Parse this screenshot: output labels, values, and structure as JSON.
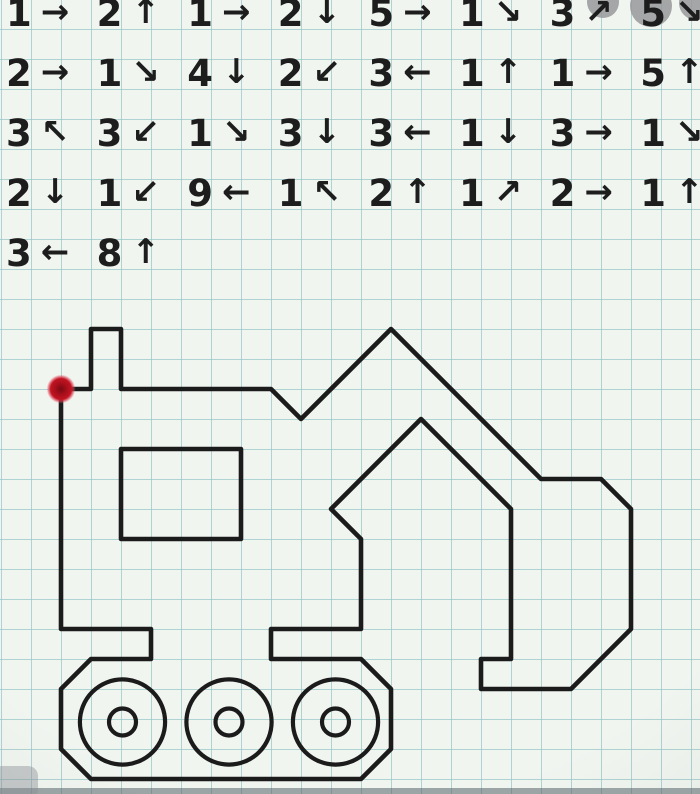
{
  "meta": {
    "title": "Graphical dictation worksheet - draw-by-arrows excavator"
  },
  "instructions": {
    "rows": [
      {
        "items": [
          {
            "n": "1",
            "dir": "right",
            "arrow": "→"
          },
          {
            "n": "2",
            "dir": "up",
            "arrow": "↑"
          },
          {
            "n": "1",
            "dir": "right",
            "arrow": "→"
          },
          {
            "n": "2",
            "dir": "down",
            "arrow": "↓"
          },
          {
            "n": "5",
            "dir": "right",
            "arrow": "→"
          },
          {
            "n": "1",
            "dir": "down-right",
            "arrow": "↘"
          },
          {
            "n": "3",
            "dir": "up-right",
            "arrow": "↗"
          },
          {
            "n": "5",
            "dir": "down-right",
            "arrow": "↘"
          }
        ]
      },
      {
        "items": [
          {
            "n": "2",
            "dir": "right",
            "arrow": "→"
          },
          {
            "n": "1",
            "dir": "down-right",
            "arrow": "↘"
          },
          {
            "n": "4",
            "dir": "down",
            "arrow": "↓"
          },
          {
            "n": "2",
            "dir": "down-left",
            "arrow": "↙"
          },
          {
            "n": "3",
            "dir": "left",
            "arrow": "←"
          },
          {
            "n": "1",
            "dir": "up",
            "arrow": "↑"
          },
          {
            "n": "1",
            "dir": "right",
            "arrow": "→"
          },
          {
            "n": "5",
            "dir": "up",
            "arrow": "↑"
          }
        ]
      },
      {
        "items": [
          {
            "n": "3",
            "dir": "up-left",
            "arrow": "↖"
          },
          {
            "n": "3",
            "dir": "down-left",
            "arrow": "↙"
          },
          {
            "n": "1",
            "dir": "down-right",
            "arrow": "↘"
          },
          {
            "n": "3",
            "dir": "down",
            "arrow": "↓"
          },
          {
            "n": "3",
            "dir": "left",
            "arrow": "←"
          },
          {
            "n": "1",
            "dir": "down",
            "arrow": "↓"
          },
          {
            "n": "3",
            "dir": "right",
            "arrow": "→"
          },
          {
            "n": "1",
            "dir": "down-right",
            "arrow": "↘"
          }
        ]
      },
      {
        "items": [
          {
            "n": "2",
            "dir": "down",
            "arrow": "↓"
          },
          {
            "n": "1",
            "dir": "down-left",
            "arrow": "↙"
          },
          {
            "n": "9",
            "dir": "left",
            "arrow": "←"
          },
          {
            "n": "1",
            "dir": "up-left",
            "arrow": "↖"
          },
          {
            "n": "2",
            "dir": "up",
            "arrow": "↑"
          },
          {
            "n": "1",
            "dir": "up-right",
            "arrow": "↗"
          },
          {
            "n": "2",
            "dir": "right",
            "arrow": "→"
          },
          {
            "n": "1",
            "dir": "up",
            "arrow": "↑"
          }
        ]
      },
      {
        "items": [
          {
            "n": "3",
            "dir": "left",
            "arrow": "←"
          },
          {
            "n": "8",
            "dir": "up",
            "arrow": "↑"
          }
        ]
      }
    ]
  },
  "figure": {
    "kind": "excavator-outline-on-grid",
    "grid_cell_px": 30,
    "origin_px": [
      61,
      389
    ],
    "stroke_color": "#1b1b1b",
    "stroke_width_px": 4.6,
    "start_dot": {
      "grid": [
        0,
        0
      ],
      "radius_px": 11.5,
      "color": "#c21422",
      "core_color": "#7a0a12"
    },
    "outline_grid": [
      [
        0,
        0
      ],
      [
        1,
        0
      ],
      [
        1,
        -2
      ],
      [
        2,
        -2
      ],
      [
        2,
        0
      ],
      [
        7,
        0
      ],
      [
        8,
        1
      ],
      [
        11,
        -2
      ],
      [
        16,
        3
      ],
      [
        18,
        3
      ],
      [
        19,
        4
      ],
      [
        19,
        8
      ],
      [
        17,
        10
      ],
      [
        14,
        10
      ],
      [
        14,
        9
      ],
      [
        15,
        9
      ],
      [
        15,
        4
      ],
      [
        12,
        1
      ],
      [
        9,
        4
      ],
      [
        10,
        5
      ],
      [
        10,
        8
      ],
      [
        7,
        8
      ],
      [
        7,
        9
      ],
      [
        10,
        9
      ],
      [
        11,
        10
      ],
      [
        11,
        12
      ],
      [
        10,
        13
      ],
      [
        1,
        13
      ],
      [
        0,
        12
      ],
      [
        0,
        10
      ],
      [
        1,
        9
      ],
      [
        3,
        9
      ],
      [
        3,
        8
      ],
      [
        0,
        8
      ]
    ],
    "window_grid": {
      "x": 2,
      "y": 2,
      "w": 4,
      "h": 3
    },
    "wheels": {
      "cy": 11.1,
      "outer_r": 1.42,
      "inner_r": 0.45,
      "cx": [
        2.05,
        5.6,
        9.15
      ],
      "stroke_width_px": 4.2
    }
  },
  "paper": {
    "bg": "#f1f5f0",
    "grid_line_color": "#8fc0c3",
    "grid_line_px": 1.5
  },
  "watermark": {
    "color": "#97999b",
    "circles_px": [
      [
        603,
        2,
        16
      ],
      [
        651,
        6,
        21
      ],
      [
        696,
        3,
        17
      ]
    ]
  },
  "photo_artifacts": {
    "bottom_strip_color": "#55626a",
    "corner_blob_color": "#8d9296"
  }
}
